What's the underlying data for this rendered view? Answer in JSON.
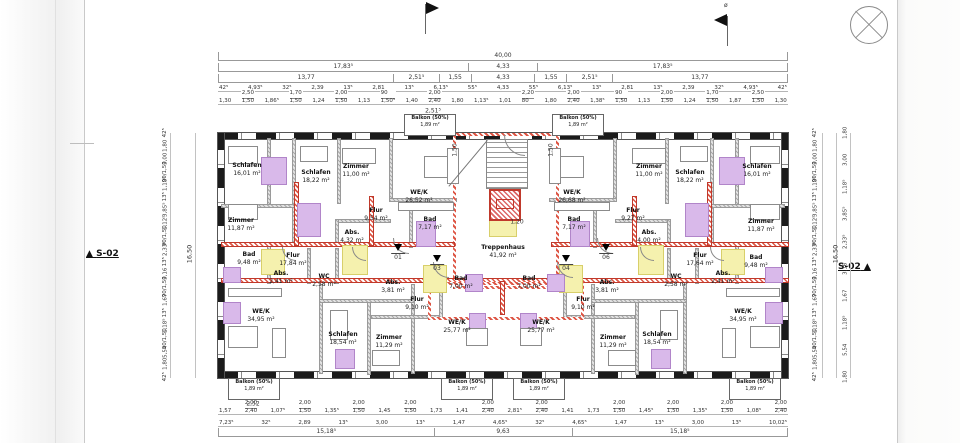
{
  "markers": {
    "section_left": "S-02",
    "section_right": "S-02",
    "flag_note": "ø"
  },
  "plan": {
    "balcony_label": "Balkon (50%)",
    "balcony_area": "1,89 m²",
    "balconies": [
      {
        "x": 429,
        "y": 124
      },
      {
        "x": 577,
        "y": 124
      },
      {
        "x": 253,
        "y": 388
      },
      {
        "x": 466,
        "y": 388
      },
      {
        "x": 538,
        "y": 388
      },
      {
        "x": 754,
        "y": 388
      }
    ],
    "rooms": [
      {
        "n": "Schlafen",
        "a": "16,01 m²",
        "x": 247,
        "y": 170
      },
      {
        "n": "Schlafen",
        "a": "18,22 m²",
        "x": 316,
        "y": 177
      },
      {
        "n": "Zimmer",
        "a": "11,00 m²",
        "x": 356,
        "y": 171
      },
      {
        "n": "WE/K",
        "a": "26,52 m²",
        "x": 419,
        "y": 197
      },
      {
        "n": "Zimmer",
        "a": "11,87 m²",
        "x": 241,
        "y": 225
      },
      {
        "n": "Flur",
        "a": "9,54 m²",
        "x": 376,
        "y": 215
      },
      {
        "n": "Abs.",
        "a": "4,32 m²",
        "x": 352,
        "y": 237
      },
      {
        "n": "Bad",
        "a": "7,17 m²",
        "x": 430,
        "y": 224
      },
      {
        "n": "Bad",
        "a": "9,48 m²",
        "x": 249,
        "y": 259
      },
      {
        "n": "Flur",
        "a": "17,84 m²",
        "x": 293,
        "y": 260
      },
      {
        "n": "Abs.",
        "a": "2,41 m²",
        "x": 281,
        "y": 278
      },
      {
        "n": "WC",
        "a": "2,58 m²",
        "x": 324,
        "y": 281
      },
      {
        "n": "WE/K",
        "a": "34,95 m²",
        "x": 261,
        "y": 316
      },
      {
        "n": "Schlafen",
        "a": "18,54 m²",
        "x": 343,
        "y": 339
      },
      {
        "n": "Zimmer",
        "a": "11,29 m²",
        "x": 389,
        "y": 342
      },
      {
        "n": "Flur",
        "a": "9,10 m²",
        "x": 417,
        "y": 304
      },
      {
        "n": "Abs.",
        "a": "3,81 m²",
        "x": 393,
        "y": 287
      },
      {
        "n": "Bad",
        "a": "7,00 m²",
        "x": 461,
        "y": 283
      },
      {
        "n": "WE/K",
        "a": "25,77 m²",
        "x": 457,
        "y": 327
      },
      {
        "n": "Treppenhaus",
        "a": "41,92 m²",
        "x": 503,
        "y": 252
      },
      {
        "n": "WE/K",
        "a": "26,68 m²",
        "x": 572,
        "y": 197
      },
      {
        "n": "Zimmer",
        "a": "11,00 m²",
        "x": 649,
        "y": 171
      },
      {
        "n": "Schlafen",
        "a": "18,22 m²",
        "x": 690,
        "y": 177
      },
      {
        "n": "Schlafen",
        "a": "16,01 m²",
        "x": 757,
        "y": 171
      },
      {
        "n": "Flur",
        "a": "9,27 m²",
        "x": 633,
        "y": 215
      },
      {
        "n": "Abs.",
        "a": "4,00 m²",
        "x": 649,
        "y": 237
      },
      {
        "n": "Bad",
        "a": "7,17 m²",
        "x": 574,
        "y": 224
      },
      {
        "n": "Zimmer",
        "a": "11,87 m²",
        "x": 761,
        "y": 226
      },
      {
        "n": "Flur",
        "a": "17,64 m²",
        "x": 700,
        "y": 260
      },
      {
        "n": "Bad",
        "a": "9,48 m²",
        "x": 756,
        "y": 262
      },
      {
        "n": "Abs.",
        "a": "2,41 m²",
        "x": 723,
        "y": 278
      },
      {
        "n": "WC",
        "a": "2,58 m²",
        "x": 676,
        "y": 281
      },
      {
        "n": "Bad",
        "a": "7,00 m²",
        "x": 529,
        "y": 283
      },
      {
        "n": "Abs.",
        "a": "3,81 m²",
        "x": 607,
        "y": 287
      },
      {
        "n": "Flur",
        "a": "9,10 m²",
        "x": 583,
        "y": 304
      },
      {
        "n": "WE/K",
        "a": "25,77 m²",
        "x": 541,
        "y": 327
      },
      {
        "n": "Zimmer",
        "a": "11,29 m²",
        "x": 613,
        "y": 342
      },
      {
        "n": "Schlafen",
        "a": "18,54 m²",
        "x": 657,
        "y": 339
      },
      {
        "n": "WE/K",
        "a": "34,95 m²",
        "x": 743,
        "y": 316
      }
    ],
    "doors": [
      {
        "num": "01",
        "x": 398,
        "y": 253
      },
      {
        "num": "03",
        "x": 437,
        "y": 264
      },
      {
        "num": "04",
        "x": 566,
        "y": 264
      },
      {
        "num": "06",
        "x": 606,
        "y": 253
      }
    ]
  },
  "dims": {
    "top_total": [
      {
        "t": "40,00",
        "w": 1
      }
    ],
    "top_a": [
      {
        "t": "17,83⁵",
        "w": 17.83
      },
      {
        "t": "4,33",
        "w": 4.33
      },
      {
        "t": "17,83⁵",
        "w": 17.83
      }
    ],
    "top_b": [
      {
        "t": "13,77",
        "w": 13.77
      },
      {
        "t": "2,51⁵",
        "w": 2.51
      },
      {
        "t": "1,55",
        "w": 1.55
      },
      {
        "t": "4,33",
        "w": 4.33
      },
      {
        "t": "1,55",
        "w": 1.55
      },
      {
        "t": "2,51⁵",
        "w": 2.51
      },
      {
        "t": "13,77",
        "w": 13.77
      }
    ],
    "top_c": [
      "42⁵",
      "4,93⁵",
      "32⁵",
      "2,39",
      "13⁵",
      "2,81",
      "13⁵",
      "6,13⁵",
      "55⁵",
      "4,33",
      "55⁵",
      "6,13⁵",
      "13⁵",
      "2,81",
      "13⁵",
      "2,39",
      "32⁵",
      "4,93⁵",
      "42⁵"
    ],
    "top_d": [
      "1,30",
      "2,50|1,50",
      "1,86⁵",
      "1,70|1,50",
      "1,24",
      "2,00|1,50",
      "1,13",
      "90|1,50⁵",
      "1,40",
      "2,00|2,40",
      "1,80",
      "1,13⁵",
      "1,01",
      "2,20|80",
      "1,80",
      "2,00|2,40",
      "1,38⁵",
      "90|1,50",
      "1,13",
      "2,00|1,50",
      "1,24",
      "1,70|1,50",
      "1,87",
      "2,50|1,50",
      "1,30"
    ],
    "bottom_a": [
      "1,57",
      "2,00|2,40",
      "1,07⁵",
      "2,00|1,50",
      "1,35⁵",
      "2,00|1,50",
      "1,45",
      "2,00|1,50",
      "1,73",
      "1,41",
      "2,00|2,40",
      "2,81⁵",
      "2,00|2,40",
      "1,41",
      "1,73",
      "2,00|1,50",
      "1,45⁵",
      "2,00|1,50",
      "1,35⁵",
      "2,00|1,50",
      "1,08⁵",
      "2,00|2,40"
    ],
    "bottom_b": [
      "7,23⁵",
      "32⁵",
      "2,89",
      "13⁵",
      "3,00",
      "13⁵",
      "1,47",
      "4,65⁵",
      "32⁵",
      "4,65⁵",
      "1,47",
      "13⁵",
      "3,00",
      "13⁵",
      "10,02⁵"
    ],
    "bottom_c": [
      {
        "t": "15,18⁵",
        "w": 15.18
      },
      {
        "t": "9,63",
        "w": 9.63
      },
      {
        "t": "15,18⁵",
        "w": 15.18
      }
    ],
    "left_total": "16,50",
    "right_total": "16,50",
    "left_chain": [
      "42⁵",
      "1,80",
      "3,00",
      "90|1,50",
      "1,18⁵",
      "13⁵",
      "3,85⁵",
      "1,12⁵",
      "90|1,50",
      "2,33⁵",
      "13⁵",
      "3,16",
      "90|1,50",
      "1,67",
      "13⁵",
      "1,18⁵",
      "90|1,50",
      "5,54",
      "1,80",
      "42⁵"
    ],
    "right_chain": [
      "42⁵",
      "1,80",
      "3,00",
      "90|1,50",
      "1,18⁵",
      "13⁵",
      "3,85⁵",
      "1,12⁵",
      "90|1,50",
      "2,33⁵",
      "13⁵",
      "3,16",
      "90|1,50",
      "1,67",
      "13⁵",
      "1,18⁵",
      "90|1,50",
      "5,54",
      "1,80",
      "42⁵"
    ],
    "right_outer": [
      "1,80",
      "3,00",
      "1,18⁵",
      "3,85⁵",
      "2,33⁵",
      "3,16",
      "1,67",
      "1,18⁵",
      "5,54",
      "1,80"
    ],
    "extras": [
      {
        "t": "2,51⁵",
        "x": 433,
        "y": 111,
        "r": 0
      },
      {
        "t": "1,50",
        "x": 455,
        "y": 150,
        "r": 1
      },
      {
        "t": "1,50",
        "x": 551,
        "y": 150,
        "r": 1
      },
      {
        "t": "1,20",
        "x": 517,
        "y": 222,
        "r": 0
      },
      {
        "t": "2,52",
        "x": 253,
        "y": 404,
        "r": 0
      }
    ]
  }
}
